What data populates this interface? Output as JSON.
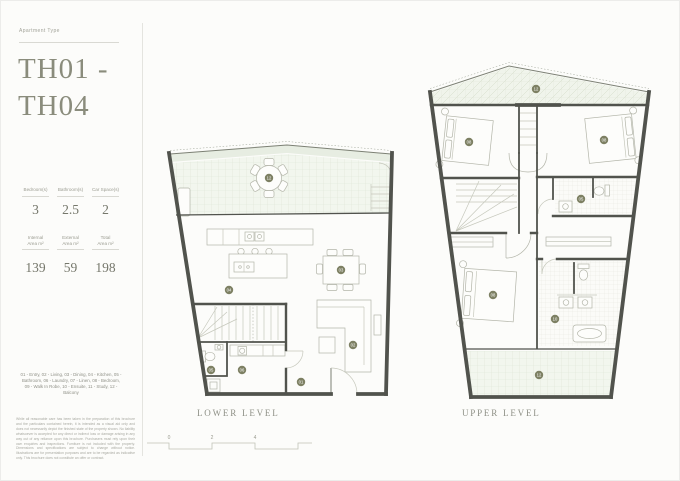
{
  "page": {
    "background": "#fcfcfa"
  },
  "colors": {
    "accent_olive": "#7d8063",
    "wall": "#51534d",
    "terrace_tint": "#e7ede2",
    "title_text": "#8a8c7c"
  },
  "sidebar": {
    "eyebrow": "Apartment Type",
    "title_line1": "TH01 -",
    "title_line2": "TH04",
    "stats_row1": [
      {
        "label": "Bedroom(s)",
        "value": "3"
      },
      {
        "label": "Bathroom(s)",
        "value": "2.5"
      },
      {
        "label": "Car Space(s)",
        "value": "2"
      }
    ],
    "stats_row2": [
      {
        "label": "Internal",
        "label2": "Area m²",
        "value": "139"
      },
      {
        "label": "External",
        "label2": "Area m²",
        "value": "59"
      },
      {
        "label": "Total",
        "label2": "Area m²",
        "value": "198"
      }
    ],
    "legend": "01 - Entry, 02 - Living, 03 - Dining, 04 - Kitchen, 05 - Bathroom, 06 - Laundry, 07 - Linen, 08 - Bedroom, 09 - Walk In Robe, 10 - Ensuite, 11 - Study, 12 - Balcony",
    "disclaimer": "While all reasonable care has been taken in the preparation of this brochure and the particulars contained herein, it is intended as a visual aid only and does not necessarily depict the finished state of the property shown. No liability whatsoever is accepted for any direct or indirect loss or damage arising in any way out of any reliance upon this brochure. Purchasers must rely upon their own enquiries and inspections. Furniture is not included with the property. Dimensions and specifications are subject to change without notice. Illustrations are for presentation purposes and are to be regarded as indicative only. This brochure does not constitute an offer or contract."
  },
  "plans": {
    "lower": {
      "title": "LOWER LEVEL",
      "rooms": [
        {
          "name": "balcony",
          "num": "12"
        },
        {
          "name": "kitchen",
          "num": "04"
        },
        {
          "name": "dining",
          "num": "03"
        },
        {
          "name": "living",
          "num": "02"
        },
        {
          "name": "bathroom",
          "num": "05"
        },
        {
          "name": "laundry",
          "num": "06"
        },
        {
          "name": "entry",
          "num": "01"
        }
      ]
    },
    "upper": {
      "title": "UPPER LEVEL",
      "rooms": [
        {
          "name": "terrace",
          "num": "12"
        },
        {
          "name": "bedroom-1",
          "num": "08"
        },
        {
          "name": "bedroom-2",
          "num": "08"
        },
        {
          "name": "bathroom",
          "num": "05"
        },
        {
          "name": "master-bedroom",
          "num": "08"
        },
        {
          "name": "ensuite",
          "num": "10"
        },
        {
          "name": "balcony",
          "num": "12"
        }
      ]
    },
    "scale_ticks": [
      "0",
      "2",
      "4"
    ]
  }
}
